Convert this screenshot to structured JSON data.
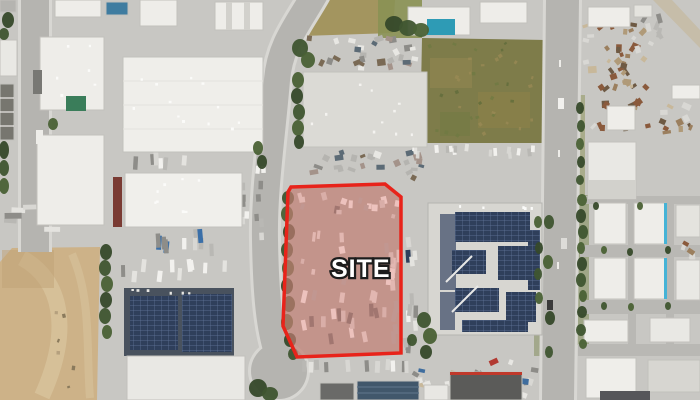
{
  "view": {
    "type": "aerial-satellite-map",
    "width_px": 700,
    "height_px": 400
  },
  "site_overlay": {
    "label": "SITE",
    "border_color": "#e8231a",
    "fill_color": "rgba(221,44,32,0.24)",
    "label_color": "#ffffff",
    "label_outline_color": "#1c1c1c"
  },
  "legend_colors": {
    "vegetation_green": "#3f5530",
    "field_green": "#7e7c4a",
    "dirt_tan": "#cdb288",
    "pavement_gray": "#c8c7c3",
    "road_gray": "#b5b4b0",
    "roof_white": "#eeede9",
    "solar_panel_blue": "#2f3f5b"
  }
}
